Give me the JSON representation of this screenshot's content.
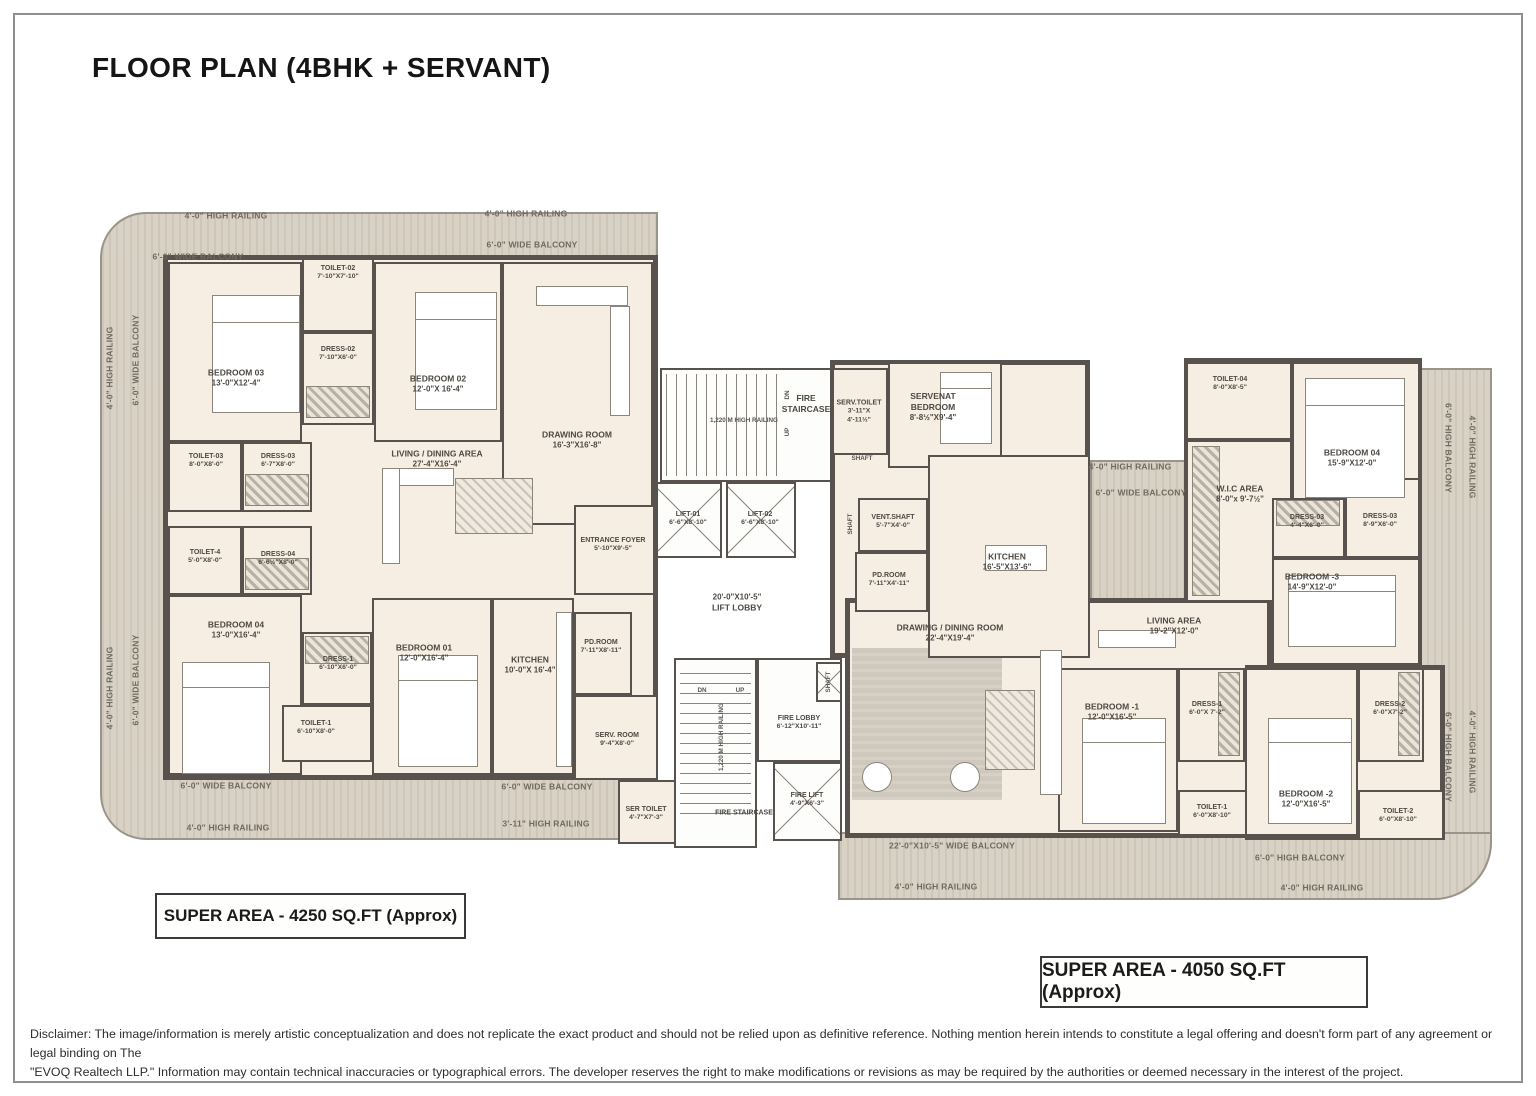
{
  "title": "FLOOR PLAN (4BHK + SERVANT)",
  "labels": {
    "railing_4ft": "4'-0\" HIGH RAILING",
    "railing_311": "3'-11\" HIGH RAILING",
    "railing_1220": "1,220 M HIGH RAILING",
    "balcony_6ft_wide": "6'-0\" WIDE BALCONY",
    "balcony_6ft_high": "6'-0\" HIGH BALCONY",
    "balcony_22ft": "22'-0\"X10'-5\" WIDE BALCONY",
    "dn": "DN",
    "up": "UP",
    "shaft": "SHAFT"
  },
  "left_unit": {
    "super_area": "SUPER AREA - 4250 SQ.FT (Approx)",
    "rooms": {
      "bedroom03": {
        "name": "BEDROOM 03",
        "dims": "13'-0\"X12'-4\""
      },
      "toilet02": {
        "name": "TOILET-02",
        "dims": "7'-10\"X7'-10\""
      },
      "dress02": {
        "name": "DRESS-02",
        "dims": "7'-10\"X6'-0\""
      },
      "bedroom02": {
        "name": "BEDROOM 02",
        "dims": "12'-0\"X 16'-4\""
      },
      "drawing_room": {
        "name": "DRAWING ROOM",
        "dims": "16'-3\"X16'-8\""
      },
      "toilet03": {
        "name": "TOILET-03",
        "dims": "8'-0\"X8'-0\""
      },
      "dress03": {
        "name": "DRESS-03",
        "dims": "6'-7\"X8'-0\""
      },
      "living_dining": {
        "name": "LIVING / DINING AREA",
        "dims": "27'-4\"X16'-4\""
      },
      "toilet4": {
        "name": "TOILET-4",
        "dims": "5'-0\"X8'-0\""
      },
      "dress04": {
        "name": "DRESS-04",
        "dims": "6'-6½\"X8'-0\""
      },
      "bedroom04": {
        "name": "BEDROOM 04",
        "dims": "13'-0\"X16'-4\""
      },
      "dress1": {
        "name": "DRESS-1",
        "dims": "6'-10\"X6'-0\""
      },
      "toilet1": {
        "name": "TOILET-1",
        "dims": "6'-10\"X8'-0\""
      },
      "bedroom01": {
        "name": "BEDROOM 01",
        "dims": "12'-0\"X16'-4\""
      },
      "kitchen": {
        "name": "KITCHEN",
        "dims": "10'-0\"X 16'-4\""
      },
      "entrance_foyer": {
        "name": "ENTRANCE FOYER",
        "dims": "5'-10\"X9'-5\""
      },
      "pd_room": {
        "name": "PD.ROOM",
        "dims": "7'-11\"X8'-11\""
      },
      "serv_room": {
        "name": "SERV. ROOM",
        "dims": "9'-4\"X8'-0\""
      },
      "ser_toilet": {
        "name": "SER TOILET",
        "dims": "4'-7\"X7'-3\""
      }
    }
  },
  "core": {
    "fire_staircase": "FIRE STAIRCASE",
    "lift01": {
      "name": "LIFT-01",
      "dims": "6'-6\"X8'-10\""
    },
    "lift02": {
      "name": "LIFT-02",
      "dims": "6'-6\"X8'-10\""
    },
    "lift_lobby": {
      "dims": "20'-0\"X10'-5\"",
      "name": "LIFT LOBBY"
    },
    "fire_lobby": {
      "name": "FIRE LOBBY",
      "dims": "6'-12\"X10'-11\""
    },
    "fire_lift": {
      "name": "FIRE LIFT",
      "dims": "4'-9\"X6'-3\""
    }
  },
  "right_unit": {
    "super_area": "SUPER AREA - 4050 SQ.FT (Approx)",
    "rooms": {
      "serv_toilet": {
        "name": "SERV.TOILET",
        "dims": "3'-11\"X 4'-11½\""
      },
      "servant_bedroom": {
        "name": "SERVENAT BEDROOM",
        "dims": "8'-8½\"X9'-4\""
      },
      "kitchen": {
        "name": "KITCHEN",
        "dims": "16'-5\"X13'-6\""
      },
      "vent_shaft": {
        "name": "VENT.SHAFT",
        "dims": "5'-7\"X4'-0\""
      },
      "pd_room": {
        "name": "PD.ROOM",
        "dims": "7'-11\"X4'-11\""
      },
      "toilet04": {
        "name": "TOILET-04",
        "dims": "8'-0\"X8'-5\""
      },
      "bedroom04": {
        "name": "BEDROOM 04",
        "dims": "15'-9\"X12'-0\""
      },
      "wic_area": {
        "name": "W.I.C AREA",
        "dims": "8'-0\"x 9'-7½\""
      },
      "dress03a": {
        "name": "DRESS-03",
        "dims": "4'-4\"X6'-0\""
      },
      "dress03b": {
        "name": "DRESS-03",
        "dims": "8'-9\"X6'-0\""
      },
      "bedroom3": {
        "name": "BEDROOM -3",
        "dims": "14'-9\"X12'-0\""
      },
      "living_area": {
        "name": "LIVING AREA",
        "dims": "19'-2\"X12'-0\""
      },
      "drawing_dining": {
        "name": "DRAWING / DINING ROOM",
        "dims": "22'-4\"X19'-4\""
      },
      "bedroom1": {
        "name": "BEDROOM -1",
        "dims": "12'-0\"X16'-5\""
      },
      "dress1": {
        "name": "DRESS-1",
        "dims": "6'-0\"X 7'-2\""
      },
      "toilet1": {
        "name": "TOILET-1",
        "dims": "6'-0\"X8'-10\""
      },
      "bedroom2": {
        "name": "BEDROOM -2",
        "dims": "12'-0\"X16'-5\""
      },
      "dress2": {
        "name": "DRESS-2",
        "dims": "6'-0\"X7'-2\""
      },
      "toilet2": {
        "name": "TOILET-2",
        "dims": "6'-0\"X8'-10\""
      }
    }
  },
  "disclaimer": {
    "line1": "Disclaimer: The image/information is merely artistic conceptualization and does not replicate the exact product and should not be relied upon as definitive reference. Nothing mention herein intends to constitute a legal offering and doesn't form part of any agreement or legal binding on The",
    "line2": "\"EVOQ Realtech LLP.\" Information may contain technical inaccuracies or typographical errors. The developer reserves the right to make modifications or revisions as may be required by the authorities or deemed necessary in the interest of the project."
  },
  "colors": {
    "wall": "#57524d",
    "room_fill": "#f6eee3",
    "balcony_fill": "#d6cec1",
    "carpet": "#cfc8bd"
  }
}
